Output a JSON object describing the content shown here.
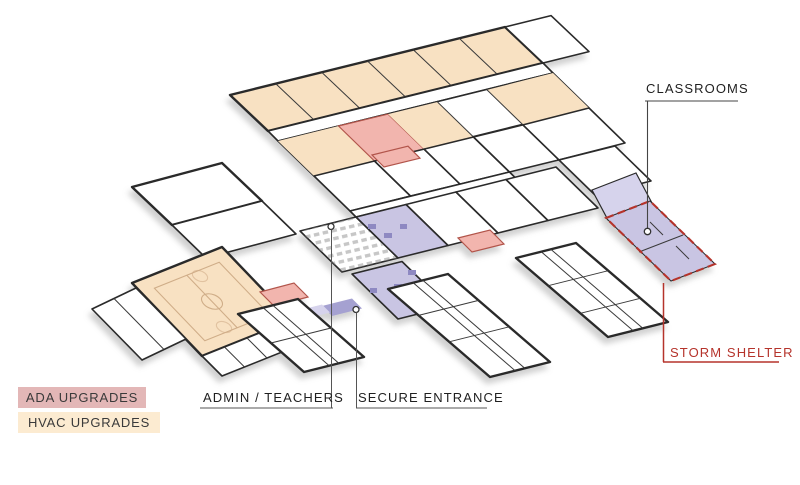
{
  "diagram": {
    "type": "axonometric-floor-plan",
    "labels": {
      "classrooms": "CLASSROOMS",
      "storm_shelter": "STORM SHELTER",
      "admin_teachers": "ADMIN / TEACHERS",
      "secure_entrance": "SECURE ENTRANCE",
      "ada_upgrades": "ADA UPGRADES",
      "hvac_upgrades": "HVAC UPGRADES"
    },
    "colors": {
      "hvac_zone_fill": "#f8e1c2",
      "ada_zone_fill": "#f2b5ae",
      "secure_zone_fill": "#c9c5e3",
      "storm_shelter_fill": "#c9c5e3",
      "storm_accent_red": "#b5332b",
      "ada_chip_bg": "#e3b7b7",
      "hvac_chip_bg": "#fcebd1",
      "wall_ink": "#2a2a2a",
      "label_ink": "#1f1f1f"
    }
  }
}
